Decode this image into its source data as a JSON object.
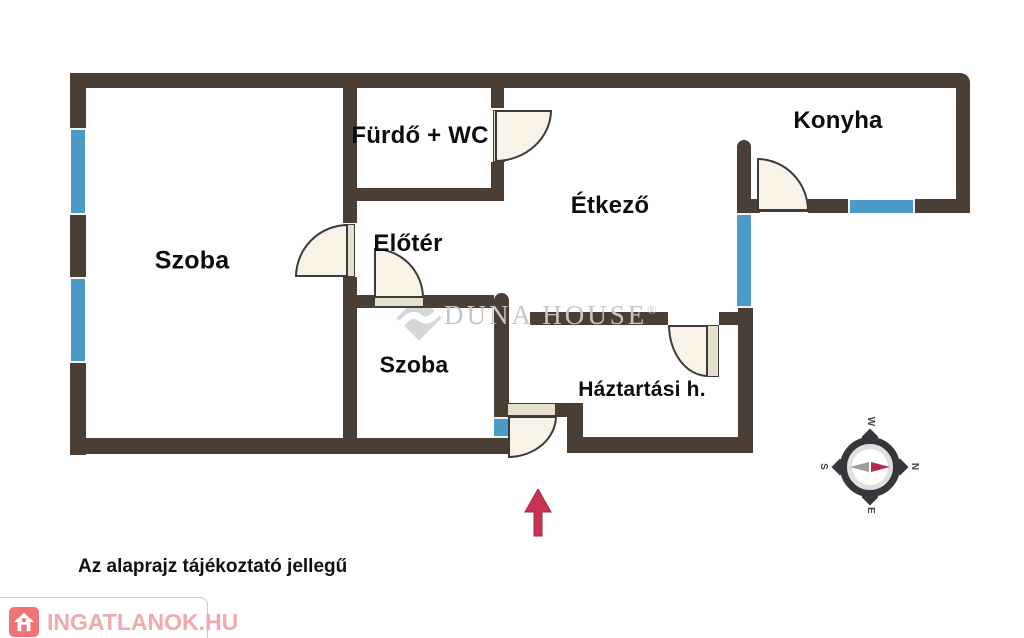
{
  "rooms": [
    {
      "name": "Szoba",
      "cx": 192,
      "cy": 261,
      "fs": 25
    },
    {
      "name": "Fürdő + WC",
      "cx": 420,
      "cy": 136,
      "fs": 24
    },
    {
      "name": "Előtér",
      "cx": 408,
      "cy": 244,
      "fs": 24
    },
    {
      "name": "Étkező",
      "cx": 610,
      "cy": 206,
      "fs": 24
    },
    {
      "name": "Konyha",
      "cx": 838,
      "cy": 121,
      "fs": 24
    },
    {
      "name": "Szoba",
      "cx": 414,
      "cy": 365,
      "fs": 23
    },
    {
      "name": "Háztartási h.",
      "cx": 642,
      "cy": 390,
      "fs": 21
    }
  ],
  "watermark": {
    "text": "DUNA HOUSE",
    "registered": "®"
  },
  "disclaimer": "Az alaprajz tájékoztató jellegű",
  "logo": {
    "text": "INGATLANOK.HU"
  },
  "compass": {
    "top": "W",
    "right": "N",
    "bottom": "E",
    "left": "S"
  },
  "colors": {
    "wall": "#4a3e35",
    "window": "#4a9bc6",
    "door": "#f9f3e7",
    "arrow": "#c73355",
    "logo_accent": "#ee7478",
    "watermark_gray": "#c6c6c6"
  }
}
